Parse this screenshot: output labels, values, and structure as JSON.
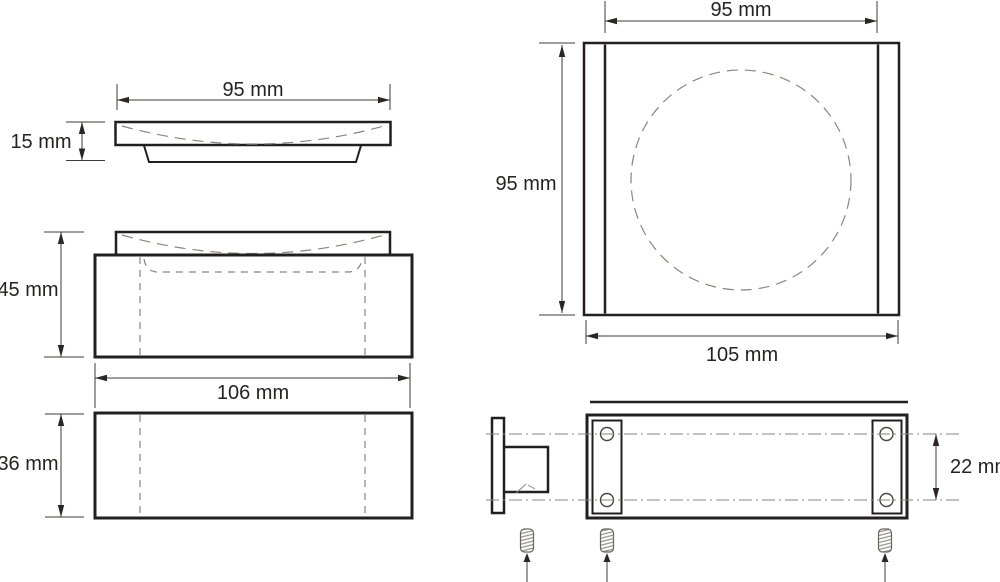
{
  "diagram": {
    "type": "technical-drawing",
    "unit": "mm",
    "screw_count": 3
  },
  "views": {
    "side": {
      "width": "95 mm",
      "height": "15 mm"
    },
    "front": {
      "height": "45 mm",
      "width": "106 mm"
    },
    "base_side": {
      "height": "36 mm"
    },
    "top": {
      "dish_width": "95 mm",
      "depth": "95 mm",
      "body_width": "105 mm"
    },
    "mounting": {
      "hole_spacing": "22 mm"
    }
  },
  "colors": {
    "outline": "#231f20",
    "dimension": "#3f3b38",
    "hidden_line": "#8a8580",
    "background": "#ffffff"
  }
}
